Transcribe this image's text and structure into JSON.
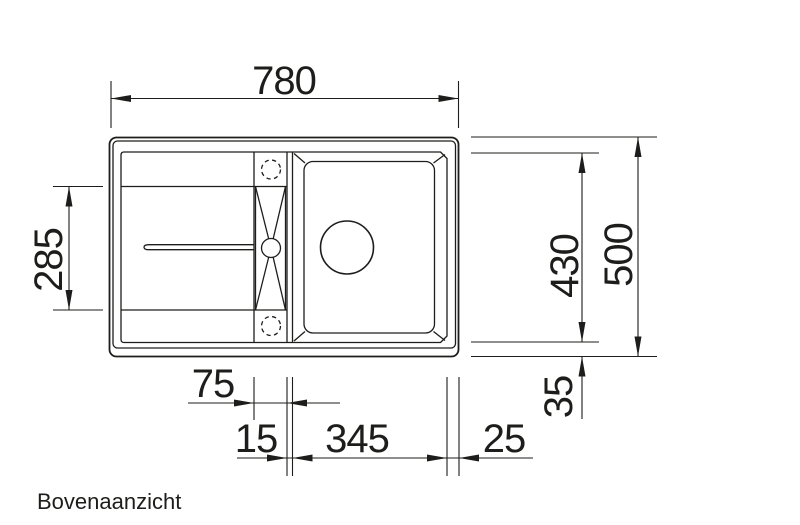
{
  "drawing": {
    "caption": "Bovenaanzicht",
    "dimensions": {
      "overall_width": "780",
      "overall_depth": "500",
      "basin_inner_depth": "430",
      "drainboard_depth": "285",
      "rim_offset_bottom": "35",
      "tap_strip_width": "75",
      "divider_width": "15",
      "bowl_width": "345",
      "rim_offset_right": "25"
    }
  }
}
